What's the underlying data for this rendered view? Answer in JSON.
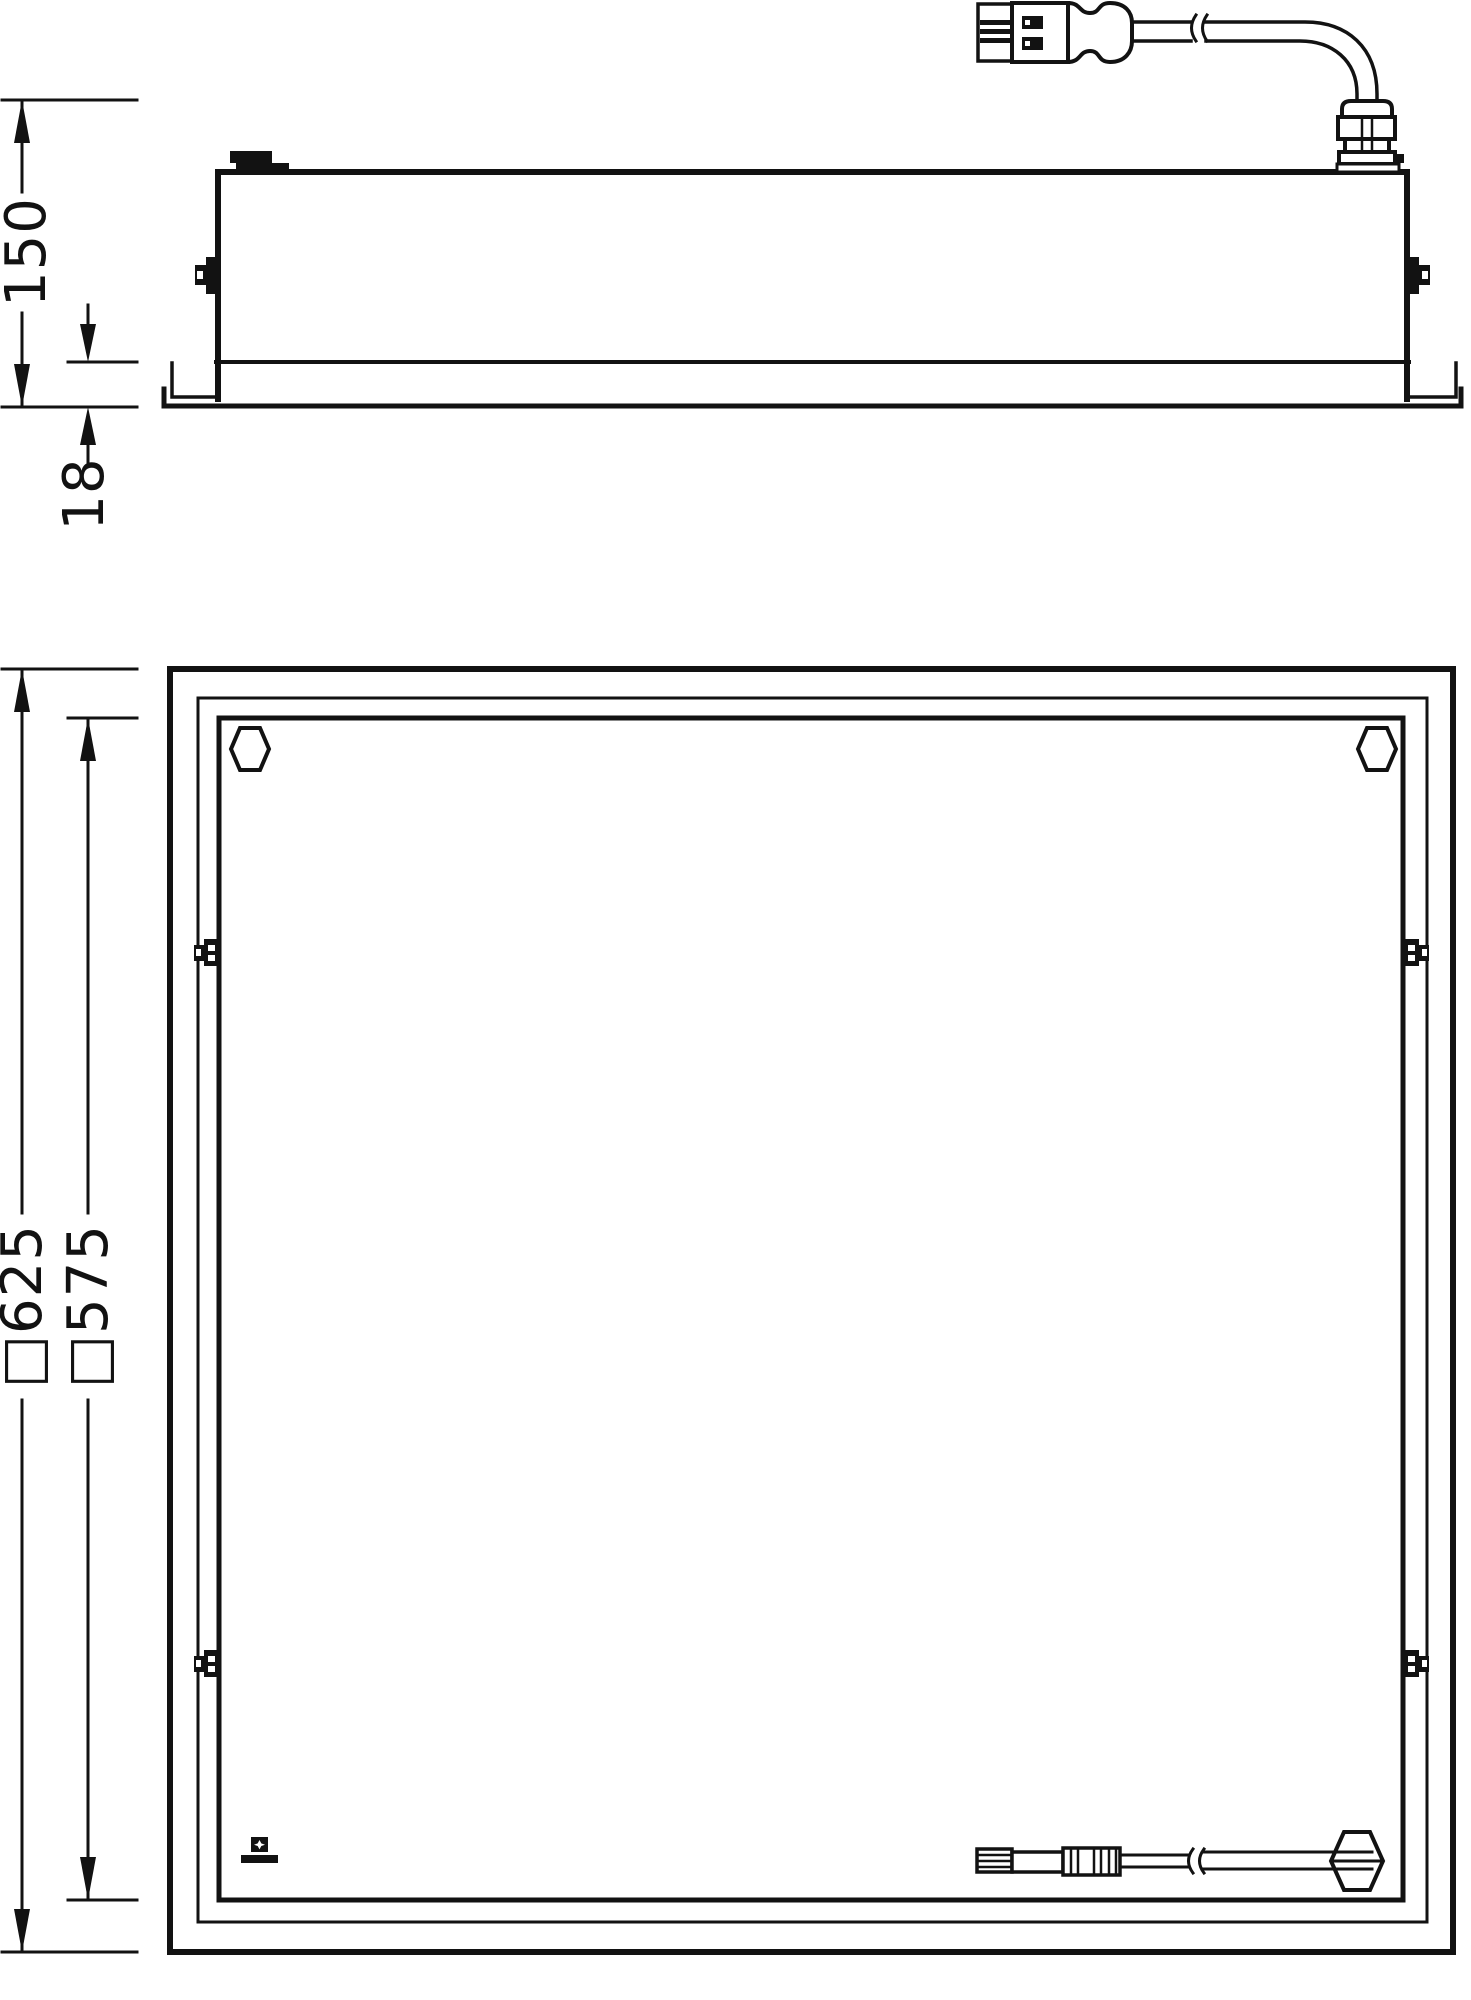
{
  "meta": {
    "background_color": "#ffffff",
    "ink_color": "#121212",
    "drawing_type": "luminaire recessed mounting dimension drawing"
  },
  "dimension_labels": {
    "total_recess_height": "150",
    "trim_height": "18",
    "frame_outer_square": "□625",
    "recess_cutout_square": "□575"
  }
}
